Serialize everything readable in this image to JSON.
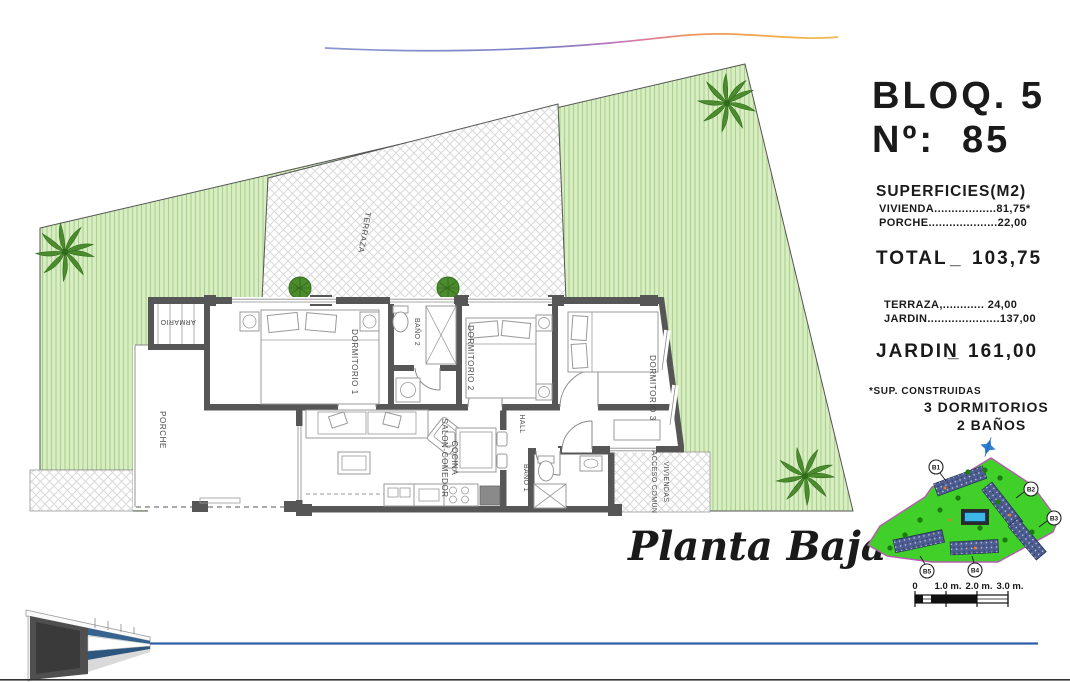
{
  "header": {
    "block": "BLOQ. 5",
    "unit_label": "Nº:",
    "unit_number": "85"
  },
  "surfaces": {
    "title": "SUPERFICIES(M2)",
    "vivienda": "VIVIENDA..................81,75*",
    "porche": "PORCHE....................22,00",
    "total_label": "TOTAL",
    "total_sep": "_",
    "total_value": "103,75",
    "terraza": "TERRAZA,............ 24,00",
    "jardin": "JARDIN.....................137,00",
    "jardin_total_label": "JARDIN",
    "jardin_total_sep": "_",
    "jardin_total_value": "161,00",
    "footnote": "*SUP. CONSTRUIDAS",
    "bedrooms": "3 DORMITORIOS",
    "bathrooms": "2 BAÑOS"
  },
  "plan": {
    "title": "Planta Baja",
    "labels": {
      "porche": "PORCHE",
      "armario": "ARMARIO",
      "dorm1": "DORMITORIO 1",
      "bano2": "BAÑO 2",
      "dorm2": "DORMITORIO 2",
      "dorm3": "DORMITORIO 3",
      "salon1": "SALON-COMEDOR",
      "salon2": "COCINA",
      "hall": "HALL",
      "bano1": "BAÑO 1",
      "acceso1": "ACCESO COMÚN",
      "acceso2": "VIVIENDAS",
      "terraza": "TERRAZA"
    }
  },
  "site_map": {
    "blocks": [
      "B1",
      "B2",
      "B3",
      "B4",
      "B5"
    ]
  },
  "scale_bar": {
    "labels": [
      "0",
      "1.0 m.",
      "2.0 m.",
      "3.0 m."
    ]
  },
  "colors": {
    "garden_green": "#d8edc2",
    "garden_stripe": "#a9d18e",
    "wall_gray": "#565656",
    "site_green": "#41cf2a",
    "site_border_purple": "#b65bb0",
    "pool_blue": "#3db7e8",
    "accent_blue_line": "#2e5fa8",
    "palm_green": "#4c8c2e",
    "logo_gradient": [
      "#8d97d0",
      "#b878bd",
      "#e07a9a",
      "#f0a845"
    ]
  }
}
